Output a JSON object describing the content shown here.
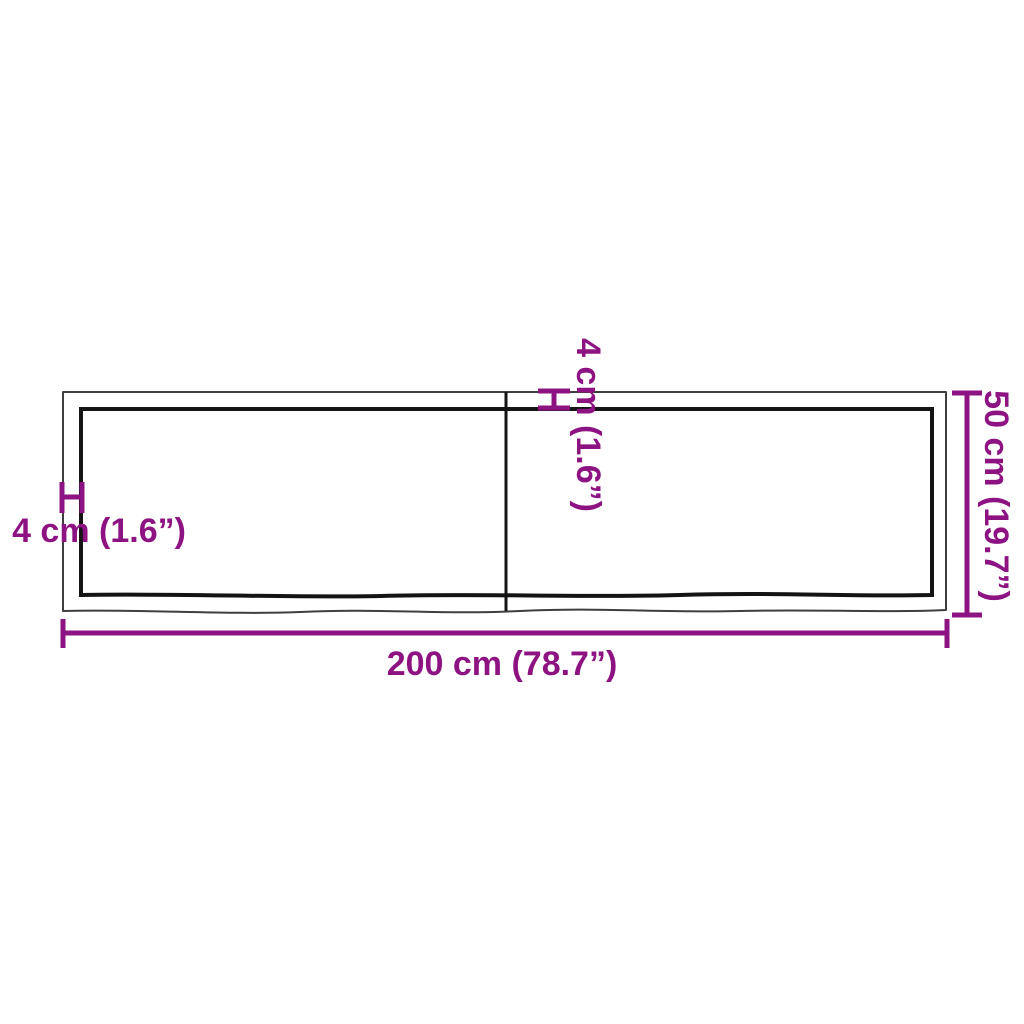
{
  "diagram": {
    "kind": "product-dimension-diagram",
    "subject": "rectangular wooden board top with center seam and live bottom edge",
    "colors": {
      "background": "#ffffff",
      "accent": "#8e1382",
      "outer_edge_line": "#3e3e3e",
      "inner_groove_line": "#141414"
    },
    "dimensions": {
      "length": {
        "label": "200 cm (78.7”)",
        "position": "bottom"
      },
      "depth": {
        "label": "50 cm (19.7”)",
        "position": "right"
      },
      "thickness_side": {
        "label": "4 cm (1.6”)",
        "position": "left"
      },
      "thickness_top": {
        "label": "4 cm (1.6”)",
        "position": "top-center"
      }
    }
  }
}
